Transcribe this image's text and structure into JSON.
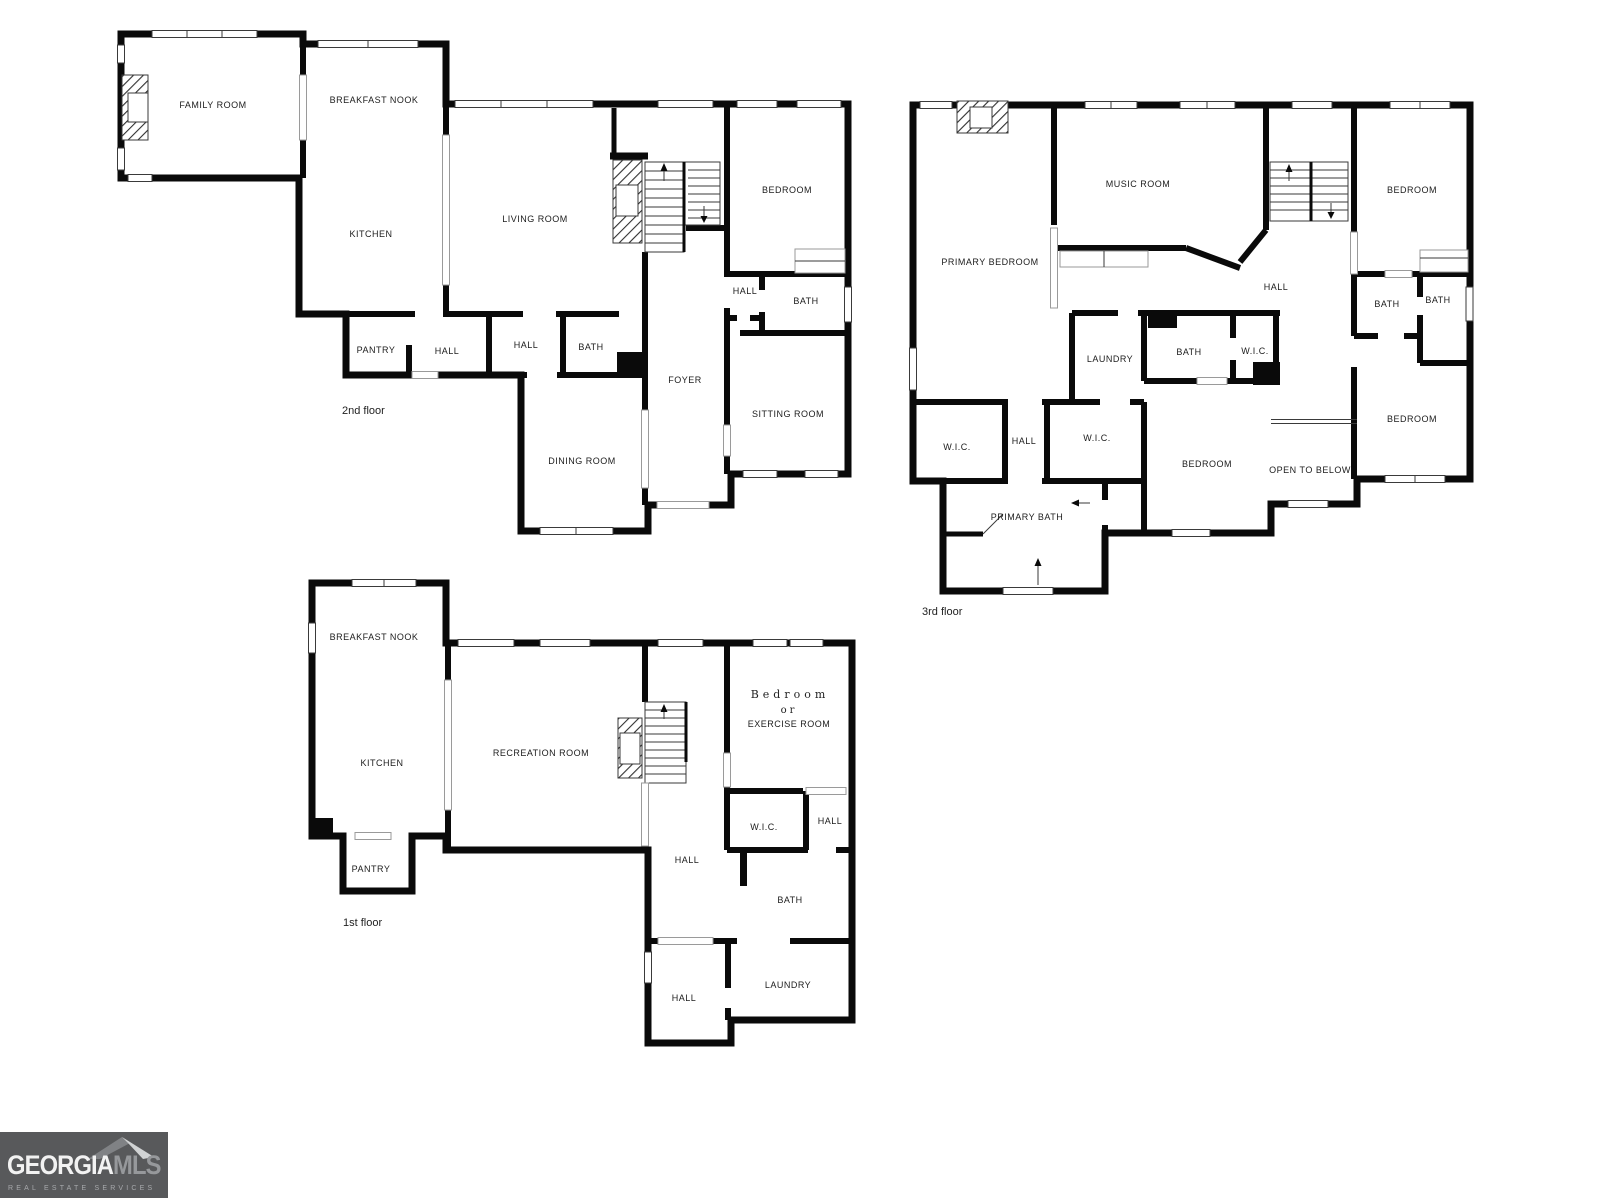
{
  "page": {
    "background": "#ffffff",
    "wall_color": "#0a0a0a"
  },
  "floors": {
    "second": {
      "label": "2nd floor",
      "rooms": {
        "family_room": "FAMILY ROOM",
        "breakfast_nook": "BREAKFAST NOOK",
        "kitchen": "KITCHEN",
        "living_room": "LIVING ROOM",
        "bedroom": "BEDROOM",
        "hall_bedroom": "HALL",
        "bath_bedroom": "BATH",
        "pantry": "PANTRY",
        "hall_a": "HALL",
        "hall_b": "HALL",
        "bath": "BATH",
        "foyer": "FOYER",
        "sitting_room": "SITTING ROOM",
        "dining_room": "DINING ROOM"
      }
    },
    "third": {
      "label": "3rd floor",
      "rooms": {
        "primary_bedroom": "PRIMARY BEDROOM",
        "music_room": "MUSIC ROOM",
        "bedroom_ne": "BEDROOM",
        "hall": "HALL",
        "bath_e1": "BATH",
        "bath_e2": "BATH",
        "laundry": "LAUNDRY",
        "bath_center": "BATH",
        "wic_center": "W.I.C.",
        "wic_w": "W.I.C.",
        "hall_w": "HALL",
        "wic_mid": "W.I.C.",
        "bedroom_s": "BEDROOM",
        "open_to_below": "OPEN TO BELOW",
        "bedroom_se": "BEDROOM",
        "primary_bath": "PRIMARY BATH"
      }
    },
    "first": {
      "label": "1st floor",
      "rooms": {
        "breakfast_nook": "BREAKFAST NOOK",
        "kitchen": "KITCHEN",
        "pantry": "PANTRY",
        "recreation_room": "RECREATION ROOM",
        "bedroom_line1": "Bedroom",
        "bedroom_line2": "or",
        "bedroom_line3": "EXERCISE ROOM",
        "wic": "W.I.C.",
        "hall_e": "HALL",
        "hall_center": "HALL",
        "bath": "BATH",
        "hall_s": "HALL",
        "laundry": "LAUNDRY"
      }
    }
  },
  "logo": {
    "brand_primary": "GEORGIA",
    "brand_secondary": "MLS",
    "tagline": "REAL ESTATE SERVICES",
    "background": "#58595b",
    "primary_color": "#f2f2f2",
    "secondary_color": "#96989b",
    "tagline_color": "#a7a9ac"
  }
}
